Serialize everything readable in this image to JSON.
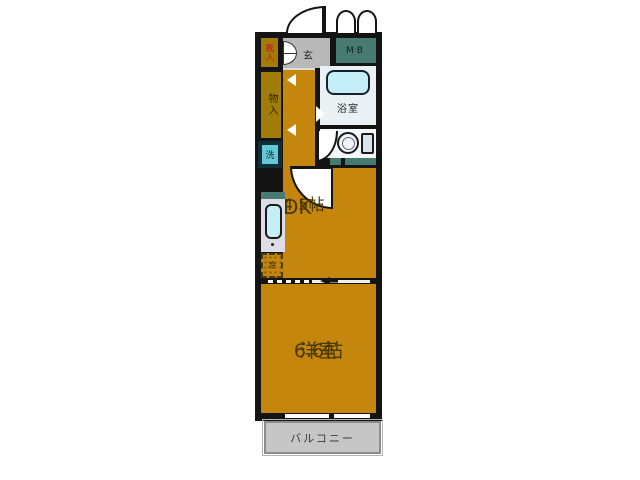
{
  "colors": {
    "wall": "#141414",
    "room": "#c5860e",
    "closet": "#a17c08",
    "entryGray": "#b8b8b8",
    "teal": "#477a71",
    "bathBg": "#e9f1f5",
    "tub": "#c6eef6",
    "wcBg": "#f5f8fa",
    "sinkBg": "#dddde6",
    "washer": "#64c8d6",
    "balcony": "#c6c6c6",
    "labelDark": "#4a3800",
    "labelRed": "#c0301e"
  },
  "rooms": {
    "entrance": "玄",
    "shoe_cabinet": "靴入",
    "meter_box": "MB",
    "bathroom": "浴室",
    "closet": "物入",
    "toilet": "WC",
    "washer": "洗",
    "refrigerator": "冷",
    "dining_kitchen": "DK",
    "dining_kitchen_size": "4.5帖",
    "western_room": "洋室",
    "western_room_size": "6.6帖",
    "balcony": "バルコニー"
  }
}
